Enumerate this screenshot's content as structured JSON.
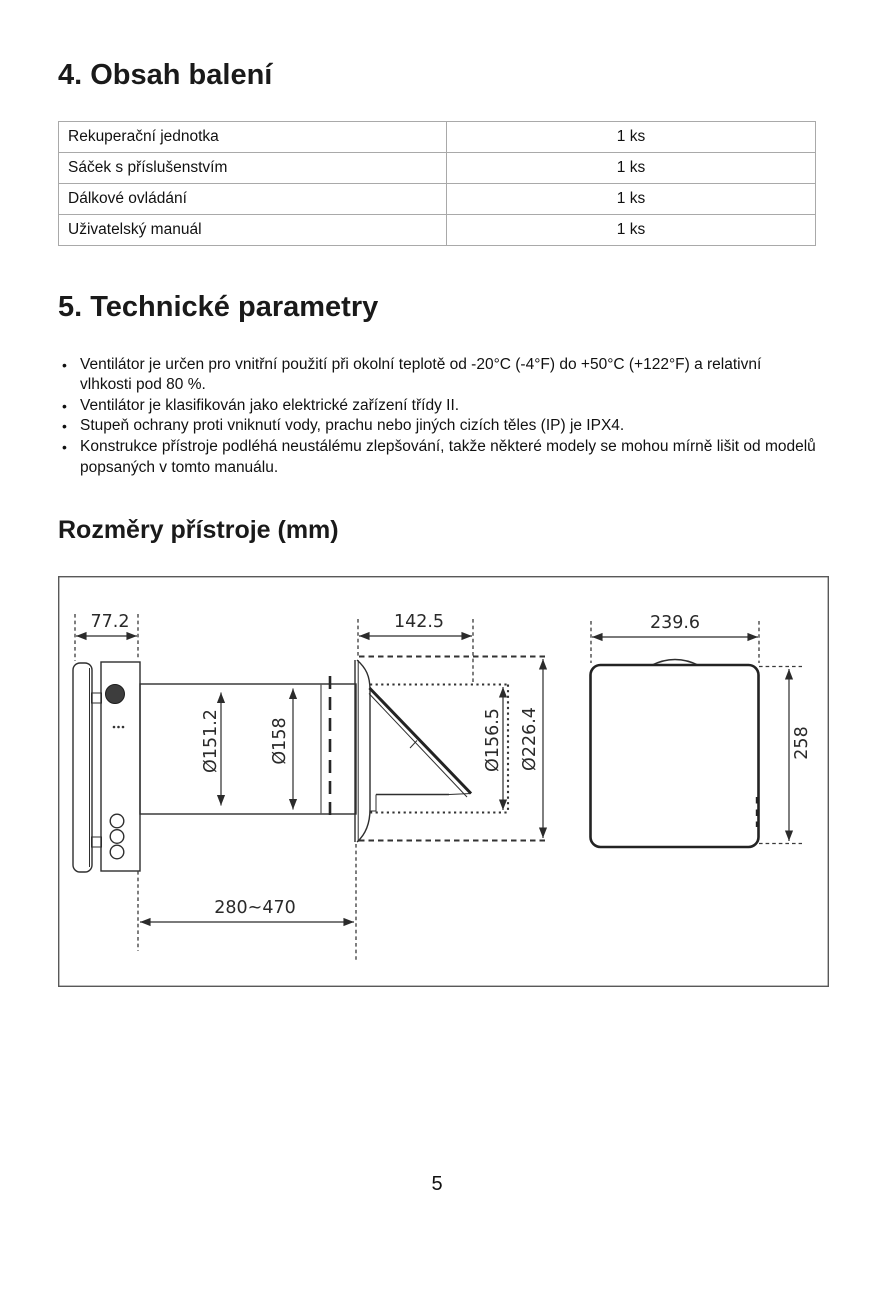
{
  "page": {
    "number": "5"
  },
  "sections": {
    "package": {
      "title": "4. Obsah balení",
      "table": {
        "rows": [
          {
            "item": "Rekuperační jednotka",
            "qty": "1 ks"
          },
          {
            "item": "Sáček s příslušenstvím",
            "qty": "1 ks"
          },
          {
            "item": "Dálkové ovládání",
            "qty": "1 ks"
          },
          {
            "item": "Uživatelský manuál",
            "qty": "1 ks"
          }
        ]
      }
    },
    "tech": {
      "title": "5. Technické parametry",
      "bullets": [
        "Ventilátor je určen pro vnitřní použití při okolní teplotě od -20°C (-4°F) do +50°C (+122°F) a relativní vlhkosti pod 80 %.",
        "Ventilátor je klasifikován jako elektrické zařízení třídy II.",
        "Stupeň ochrany proti vniknutí vody, prachu nebo jiných cizích těles (IP) je IPX4.",
        "Konstrukce přístroje podléhá neustálému zlepšování, takže některé modely se mohou mírně lišit od modelů popsaných v tomto manuálu."
      ]
    },
    "dimensions": {
      "title": "Rozměry přístroje (mm)",
      "labels": {
        "front_depth": "77.2",
        "hood_depth": "142.5",
        "panel_width": "239.6",
        "duct_inner": "Ø151.2",
        "duct_outer": "Ø158",
        "hood_hole": "Ø156.5",
        "hood_outer": "Ø226.4",
        "panel_height": "258",
        "duct_length": "280~470"
      }
    }
  }
}
